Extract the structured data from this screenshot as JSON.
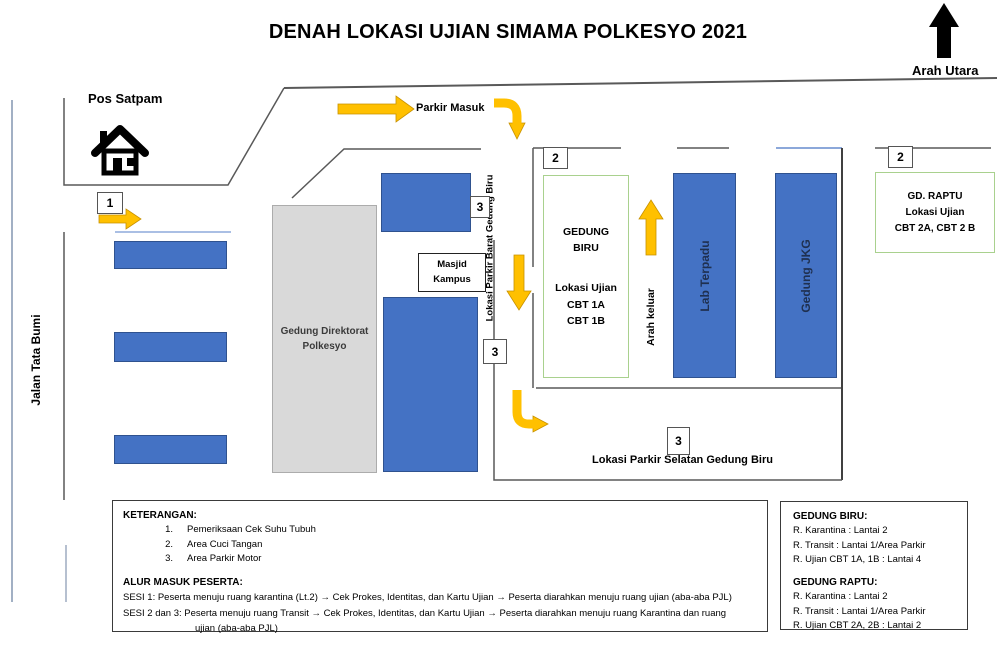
{
  "title": "DENAH LOKASI UJIAN SIMAMA POLKESYO 2021",
  "compass": {
    "label": "Arah Utara"
  },
  "map": {
    "pos_satpam_label": "Pos Satpam",
    "parkir_masuk_label": "Parkir Masuk",
    "jalan_label": "Jalan Tata Bumi",
    "direktorat_lines": [
      "Gedung Direktorat",
      "Polkesyo"
    ],
    "masjid_lines": [
      "Masjid",
      "Kampus"
    ],
    "gedung_biru_lines": [
      "GEDUNG",
      "BIRU",
      "Lokasi Ujian",
      "CBT 1A",
      "CBT 1B"
    ],
    "lab_terpadu_label": "Lab Terpadu",
    "gedung_jkg_label": "Gedung JKG",
    "raptu_lines": [
      "GD. RAPTU",
      "Lokasi Ujian",
      "CBT 2A, CBT 2 B"
    ],
    "arah_keluar_label": "Arah keluar",
    "parkir_barat_label": "Lokasi Parkir Barat Gedung Biru",
    "parkir_selatan_label": "Lokasi Parkir Selatan Gedung Biru",
    "markers": {
      "m1": "1",
      "m2": "2",
      "m3": "3"
    }
  },
  "legend": {
    "keterangan_title": "KETERANGAN:",
    "items": [
      {
        "num": "1.",
        "text": "Pemeriksaan Cek Suhu Tubuh"
      },
      {
        "num": "2.",
        "text": "Area Cuci Tangan"
      },
      {
        "num": "3.",
        "text": "Area Parkir Motor"
      }
    ],
    "alur_title": "ALUR MASUK PESERTA:",
    "sesi1": "SESI 1: Peserta menuju ruang karantina (Lt.2) → Cek Prokes, Identitas, dan Kartu Ujian → Peserta diarahkan menuju ruang ujian (aba-aba PJL)",
    "sesi2": "SESI 2 dan 3: Peserta menuju ruang Transit → Cek Prokes, Identitas, dan Kartu Ujian → Peserta diarahkan menuju ruang Karantina dan  ruang",
    "sesi2_cont": "ujian (aba-aba PJL)"
  },
  "info": {
    "biru_title": "GEDUNG BIRU:",
    "biru_lines": [
      "R. Karantina : Lantai 2",
      "R. Transit : Lantai 1/Area Parkir",
      "R. Ujian CBT 1A, 1B : Lantai 4"
    ],
    "raptu_title": "GEDUNG RAPTU:",
    "raptu_lines": [
      "R. Karantina : Lantai 2",
      "R. Transit : Lantai 1/Area Parkir",
      "R. Ujian CBT 2A, 2B : Lantai 2"
    ]
  },
  "colors": {
    "building_blue": "#4472C4",
    "arrow_yellow": "#FFC000",
    "green_border": "#A9D18E",
    "gray_fill": "#D9D9D9"
  }
}
